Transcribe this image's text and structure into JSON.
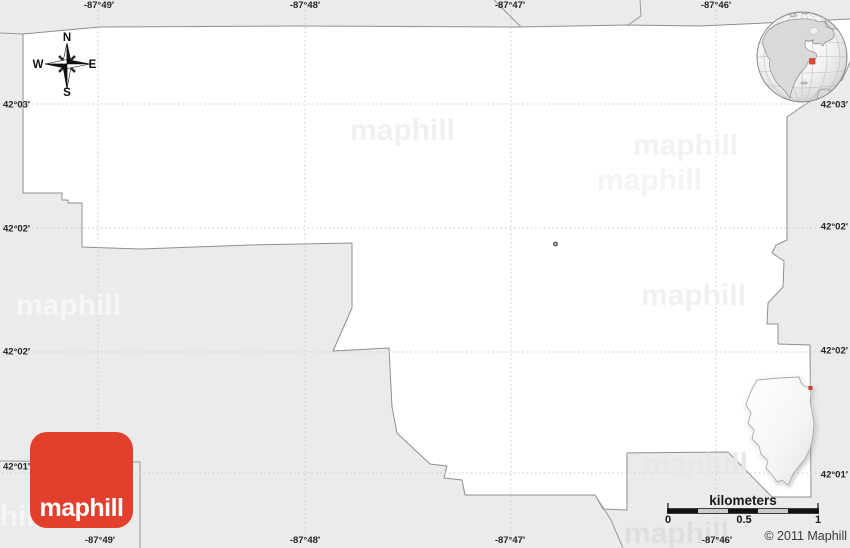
{
  "colors": {
    "background": "#ebebeb",
    "region_fill": "#ffffff",
    "region_border": "#8f8f8f",
    "neighbor_border": "#9a9a9a",
    "grid": "#c9c9c9",
    "logo_red": "#e2402c",
    "marker_red": "#e6492f",
    "scale_dark": "#111111",
    "scale_light": "#c9c9c9"
  },
  "watermark_text": "maphill",
  "watermarks": [
    {
      "x": 350,
      "y": 116,
      "color": "#f0f0f0"
    },
    {
      "x": 633,
      "y": 131,
      "color": "#f2f2f2"
    },
    {
      "x": 597,
      "y": 166,
      "color": "#f4f4f4"
    },
    {
      "x": 16,
      "y": 291,
      "color": "#f7f7f7"
    },
    {
      "x": 641,
      "y": 281,
      "color": "#f0f0f0"
    },
    {
      "x": 643,
      "y": 450,
      "color": "#e7e7e7"
    },
    {
      "x": 624,
      "y": 519,
      "color": "#dedede"
    },
    {
      "x": -62,
      "y": 502,
      "color": "#f5f5f5"
    }
  ],
  "coordinates": {
    "top": [
      {
        "label": "-87°49'",
        "x": 99
      },
      {
        "label": "-87°48'",
        "x": 305
      },
      {
        "label": "-87°47'",
        "x": 510
      },
      {
        "label": "-87°46'",
        "x": 716
      }
    ],
    "bottom": [
      {
        "label": "-87°49'",
        "x": 100
      },
      {
        "label": "-87°48'",
        "x": 305
      },
      {
        "label": "-87°47'",
        "x": 510
      },
      {
        "label": "-87°46'",
        "x": 717
      }
    ],
    "left": [
      {
        "label": "42°03'",
        "y": 105
      },
      {
        "label": "42°02'",
        "y": 229
      },
      {
        "label": "42°02'",
        "y": 352
      },
      {
        "label": "42°01'",
        "y": 467
      }
    ],
    "right": [
      {
        "label": "42°03'",
        "y": 105
      },
      {
        "label": "42°02'",
        "y": 227
      },
      {
        "label": "42°02'",
        "y": 351
      },
      {
        "label": "42°01'",
        "y": 475
      }
    ]
  },
  "gridlines": {
    "vertical_x": [
      98,
      305,
      511,
      716
    ],
    "horizontal_y": [
      104,
      228,
      352,
      473
    ]
  },
  "compass": {
    "north": "N",
    "east": "E",
    "south": "S",
    "west": "W"
  },
  "scale_bar": {
    "title": "kilometers",
    "tick_labels": [
      {
        "label": "0",
        "x": 668
      },
      {
        "label": "0.5",
        "x": 744
      },
      {
        "label": "1",
        "x": 818
      }
    ],
    "segments": [
      "dark",
      "light",
      "dark",
      "light",
      "dark"
    ],
    "x_start": 668,
    "x_end": 818,
    "y": 509,
    "height": 4
  },
  "logo": {
    "label": "maphill"
  },
  "copyright": "© 2011 Maphill"
}
